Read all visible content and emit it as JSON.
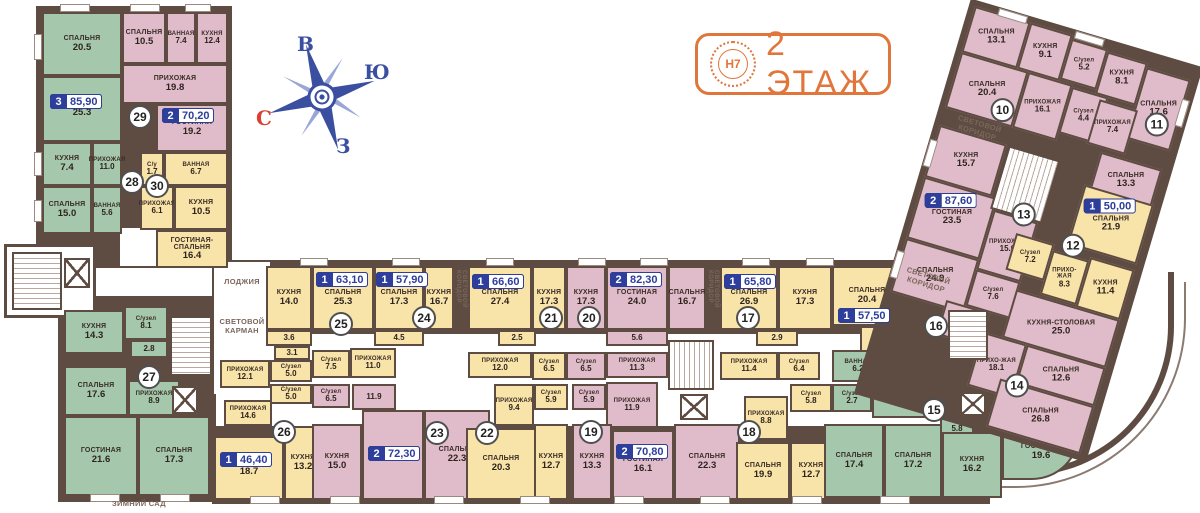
{
  "header": {
    "logo_text": "Н7",
    "title": "2 ЭТАЖ"
  },
  "compass": {
    "top": "В",
    "right": "Ю",
    "bottom": "З",
    "left": "С"
  },
  "labels": {
    "loggia": "ЛОДЖИЯ",
    "light_pocket": "СВЕТОВОЙ КАРМАН",
    "light_corridor": "СВЕТОВОЙ КОРИДОР",
    "winter_garden": "ЗИМНИЙ САД"
  },
  "colors": {
    "green": "#A5C7AB",
    "pink": "#E0BCCA",
    "yellow": "#F8E3A9",
    "wall": "#5E4B41",
    "badge_blue": "#2D3E9B",
    "accent_orange": "#E0763C",
    "compass_blue": "#3B4FA0",
    "compass_red": "#D9402F"
  },
  "apartments": [
    {
      "number": "10",
      "color": "pink",
      "rooms": [
        {
          "name": "СПАЛЬНЯ",
          "area": "13.1"
        },
        {
          "name": "КУХНЯ",
          "area": "9.1"
        },
        {
          "name": "С/узел",
          "area": "5.2"
        },
        {
          "name": "СПАЛЬНЯ",
          "area": "20.4"
        },
        {
          "name": "ПРИХОЖАЯ",
          "area": "16.1"
        },
        {
          "name": "С/узел",
          "area": "4.4"
        }
      ]
    },
    {
      "number": "11",
      "color": "pink",
      "rooms": [
        {
          "name": "КУХНЯ",
          "area": "8.1"
        },
        {
          "name": "СПАЛЬНЯ",
          "area": "17.6"
        },
        {
          "name": "ПРИХОЖАЯ",
          "area": "7.4"
        },
        {
          "name": "СПАЛЬНЯ",
          "area": "13.3"
        }
      ]
    },
    {
      "number": "12",
      "color": "yellow",
      "badge": {
        "rooms": "1",
        "area": "50,00"
      },
      "rooms": [
        {
          "name": "СПАЛЬНЯ",
          "area": "21.9"
        },
        {
          "name": "С/узел",
          "area": "7.2"
        },
        {
          "name": "ПРИХО-ЖАЯ",
          "area": "8.3"
        },
        {
          "name": "КУХНЯ",
          "area": "11.4"
        }
      ]
    },
    {
      "number": "13",
      "color": "pink",
      "badge": {
        "rooms": "2",
        "area": "87,60"
      },
      "rooms": [
        {
          "name": "КУХНЯ",
          "area": "15.7"
        },
        {
          "name": "ГОСТИНАЯ",
          "area": "23.5"
        },
        {
          "name": "ПРИХОЖАЯ",
          "area": "15.0"
        },
        {
          "name": "СПАЛЬНЯ",
          "area": "24.9"
        },
        {
          "name": "С/узел",
          "area": "7.6"
        },
        {
          "name": "С/узел",
          "area": "6.6"
        }
      ]
    },
    {
      "number": "14",
      "color": "pink",
      "rooms": [
        {
          "name": "КУХНЯ-СТОЛОВАЯ",
          "area": "25.0"
        },
        {
          "name": "ПРИХО-ЖАЯ",
          "area": "18.1"
        },
        {
          "name": "СПАЛЬНЯ",
          "area": "12.6"
        },
        {
          "name": "СПАЛЬНЯ",
          "area": "26.8"
        }
      ]
    },
    {
      "number": "15",
      "color": "green",
      "rooms": [
        {
          "name": "ВАННАЯ",
          "area": "6.2"
        },
        {
          "name": "С/узел",
          "area": "2.7"
        },
        {
          "name": "ПРИХОЖАЯ",
          "area": "20.7"
        },
        {
          "name": "",
          "area": "5.8"
        },
        {
          "name": "СПАЛЬНЯ",
          "area": "17.4"
        },
        {
          "name": "СПАЛЬНЯ",
          "area": "17.2"
        },
        {
          "name": "КУХНЯ",
          "area": "16.2"
        },
        {
          "name": "ГОСТИНАЯ",
          "area": "19.6"
        }
      ]
    },
    {
      "number": "16",
      "color": "yellow",
      "badge": {
        "rooms": "1",
        "area": "57,50"
      },
      "rooms": [
        {
          "name": "СПАЛЬНЯ",
          "area": "20.4"
        },
        {
          "name": "КУХНЯ",
          "area": "19.6"
        },
        {
          "name": "С/узел",
          "area": "6.2"
        },
        {
          "name": "ПРИХОЖАЯ",
          "area": "11.3"
        }
      ]
    },
    {
      "number": "17",
      "color": "yellow",
      "badge": {
        "rooms": "1",
        "area": "65,80"
      },
      "rooms": [
        {
          "name": "СПАЛЬНЯ",
          "area": "26.9"
        },
        {
          "name": "КУХНЯ",
          "area": "17.3"
        },
        {
          "name": "",
          "area": "2.9"
        },
        {
          "name": "ПРИХОЖАЯ",
          "area": "11.4"
        },
        {
          "name": "С/узел",
          "area": "6.4"
        }
      ]
    },
    {
      "number": "18",
      "color": "yellow",
      "rooms": [
        {
          "name": "ПРИХОЖАЯ",
          "area": "8.8"
        },
        {
          "name": "С/узел",
          "area": "5.8"
        },
        {
          "name": "СПАЛЬНЯ",
          "area": "19.9"
        },
        {
          "name": "КУХНЯ",
          "area": "12.7"
        }
      ]
    },
    {
      "number": "19",
      "color": "pink",
      "badge": {
        "rooms": "2",
        "area": "70,80"
      },
      "rooms": [
        {
          "name": "С/узел",
          "area": "5.9"
        },
        {
          "name": "ПРИХОЖАЯ",
          "area": "11.9"
        },
        {
          "name": "КУХНЯ",
          "area": "13.3"
        },
        {
          "name": "ГОСТИНАЯ",
          "area": "16.1"
        },
        {
          "name": "СПАЛЬНЯ",
          "area": "22.3"
        }
      ]
    },
    {
      "number": "20",
      "color": "pink",
      "badge": {
        "rooms": "2",
        "area": "82,30"
      },
      "rooms": [
        {
          "name": "КУХНЯ",
          "area": "17.3"
        },
        {
          "name": "ГОСТИНАЯ",
          "area": "24.0"
        },
        {
          "name": "",
          "area": "5.6"
        },
        {
          "name": "С/узел",
          "area": "6.5"
        },
        {
          "name": "ПРИХОЖАЯ",
          "area": "11.3"
        },
        {
          "name": "СПАЛЬНЯ",
          "area": "16.7"
        }
      ]
    },
    {
      "number": "21",
      "color": "yellow",
      "badge": {
        "rooms": "1",
        "area": "66,60"
      },
      "rooms": [
        {
          "name": "СПАЛЬНЯ",
          "area": "27.4"
        },
        {
          "name": "КУХНЯ",
          "area": "17.3"
        },
        {
          "name": "",
          "area": "2.5"
        },
        {
          "name": "ПРИХОЖАЯ",
          "area": "12.0"
        },
        {
          "name": "С/узел",
          "area": "6.5"
        }
      ]
    },
    {
      "number": "22",
      "color": "yellow",
      "rooms": [
        {
          "name": "ПРИХОЖАЯ",
          "area": "9.4"
        },
        {
          "name": "СПАЛЬНЯ",
          "area": "20.3"
        },
        {
          "name": "С/узел",
          "area": "5.9"
        },
        {
          "name": "КУХНЯ",
          "area": "12.7"
        }
      ]
    },
    {
      "number": "23",
      "color": "pink",
      "badge": {
        "rooms": "2",
        "area": "72,30"
      },
      "rooms": [
        {
          "name": "С/узел",
          "area": "6.5"
        },
        {
          "name": "",
          "area": "11.9"
        },
        {
          "name": "КУХНЯ",
          "area": "15.0"
        },
        {
          "name": "ГОСТИНАЯ",
          "area": "15.1"
        },
        {
          "name": "СПАЛЬНЯ",
          "area": "22.3"
        }
      ]
    },
    {
      "number": "24",
      "color": "yellow",
      "badge": {
        "rooms": "1",
        "area": "57,90"
      },
      "rooms": [
        {
          "name": "СПАЛЬНЯ",
          "area": "17.3"
        },
        {
          "name": "КУХНЯ",
          "area": "16.7"
        },
        {
          "name": "",
          "area": "4.5"
        },
        {
          "name": "С/узел",
          "area": "7.5"
        },
        {
          "name": "ПРИХОЖАЯ",
          "area": "11.0"
        }
      ]
    },
    {
      "number": "25",
      "color": "yellow",
      "badge": {
        "rooms": "1",
        "area": "63,10"
      },
      "rooms": [
        {
          "name": "КУХНЯ",
          "area": "14.0"
        },
        {
          "name": "СПАЛЬНЯ",
          "area": "25.3"
        },
        {
          "name": "",
          "area": "3.6"
        },
        {
          "name": "",
          "area": "3.1"
        },
        {
          "name": "ПРИХОЖАЯ",
          "area": "12.1"
        },
        {
          "name": "С/узел",
          "area": "5.0"
        }
      ]
    },
    {
      "number": "26",
      "color": "yellow",
      "badge": {
        "rooms": "1",
        "area": "46,40"
      },
      "rooms": [
        {
          "name": "С/узел",
          "area": "5.0"
        },
        {
          "name": "ПРИХОЖАЯ",
          "area": "14.6"
        },
        {
          "name": "СПАЛЬНЯ",
          "area": "18.7"
        },
        {
          "name": "КУХНЯ",
          "area": "13.2"
        }
      ]
    },
    {
      "number": "27",
      "color": "green",
      "rooms": [
        {
          "name": "КУХНЯ",
          "area": "14.3"
        },
        {
          "name": "С/узел",
          "area": "8.1"
        },
        {
          "name": "",
          "area": "2.8"
        },
        {
          "name": "СПАЛЬНЯ",
          "area": "17.6"
        },
        {
          "name": "ПРИХОЖАЯ",
          "area": "8.9"
        },
        {
          "name": "ГОСТИНАЯ",
          "area": "21.6"
        },
        {
          "name": "СПАЛЬНЯ",
          "area": "17.3"
        }
      ]
    },
    {
      "number": "28",
      "color": "green",
      "badge": {
        "rooms": "3",
        "area": "85,90"
      },
      "rooms": [
        {
          "name": "СПАЛЬНЯ",
          "area": "20.5"
        },
        {
          "name": "ГОСТИНАЯ",
          "area": "25.3"
        },
        {
          "name": "КУХНЯ",
          "area": "7.4"
        },
        {
          "name": "ПРИХОЖАЯ",
          "area": "11.0"
        },
        {
          "name": "СПАЛЬНЯ",
          "area": "15.0"
        },
        {
          "name": "ВАННАЯ",
          "area": "5.6"
        }
      ]
    },
    {
      "number": "29",
      "color": "pink",
      "badge": {
        "rooms": "2",
        "area": "70,20"
      },
      "rooms": [
        {
          "name": "СПАЛЬНЯ",
          "area": "10.5"
        },
        {
          "name": "ВАННАЯ",
          "area": "7.4"
        },
        {
          "name": "КУХНЯ",
          "area": "12.4"
        },
        {
          "name": "ПРИХОЖАЯ",
          "area": "19.8"
        },
        {
          "name": "ГОСТИНАЯ",
          "area": "19.2"
        }
      ]
    },
    {
      "number": "30",
      "color": "yellow",
      "rooms": [
        {
          "name": "С/у",
          "area": "1.7"
        },
        {
          "name": "ВАННАЯ",
          "area": "6.7"
        },
        {
          "name": "ПРИХОЖАЯ",
          "area": "6.1"
        },
        {
          "name": "КУХНЯ",
          "area": "10.5"
        },
        {
          "name": "ГОСТИНАЯ-СПАЛЬНЯ",
          "area": "16.4"
        }
      ]
    }
  ]
}
